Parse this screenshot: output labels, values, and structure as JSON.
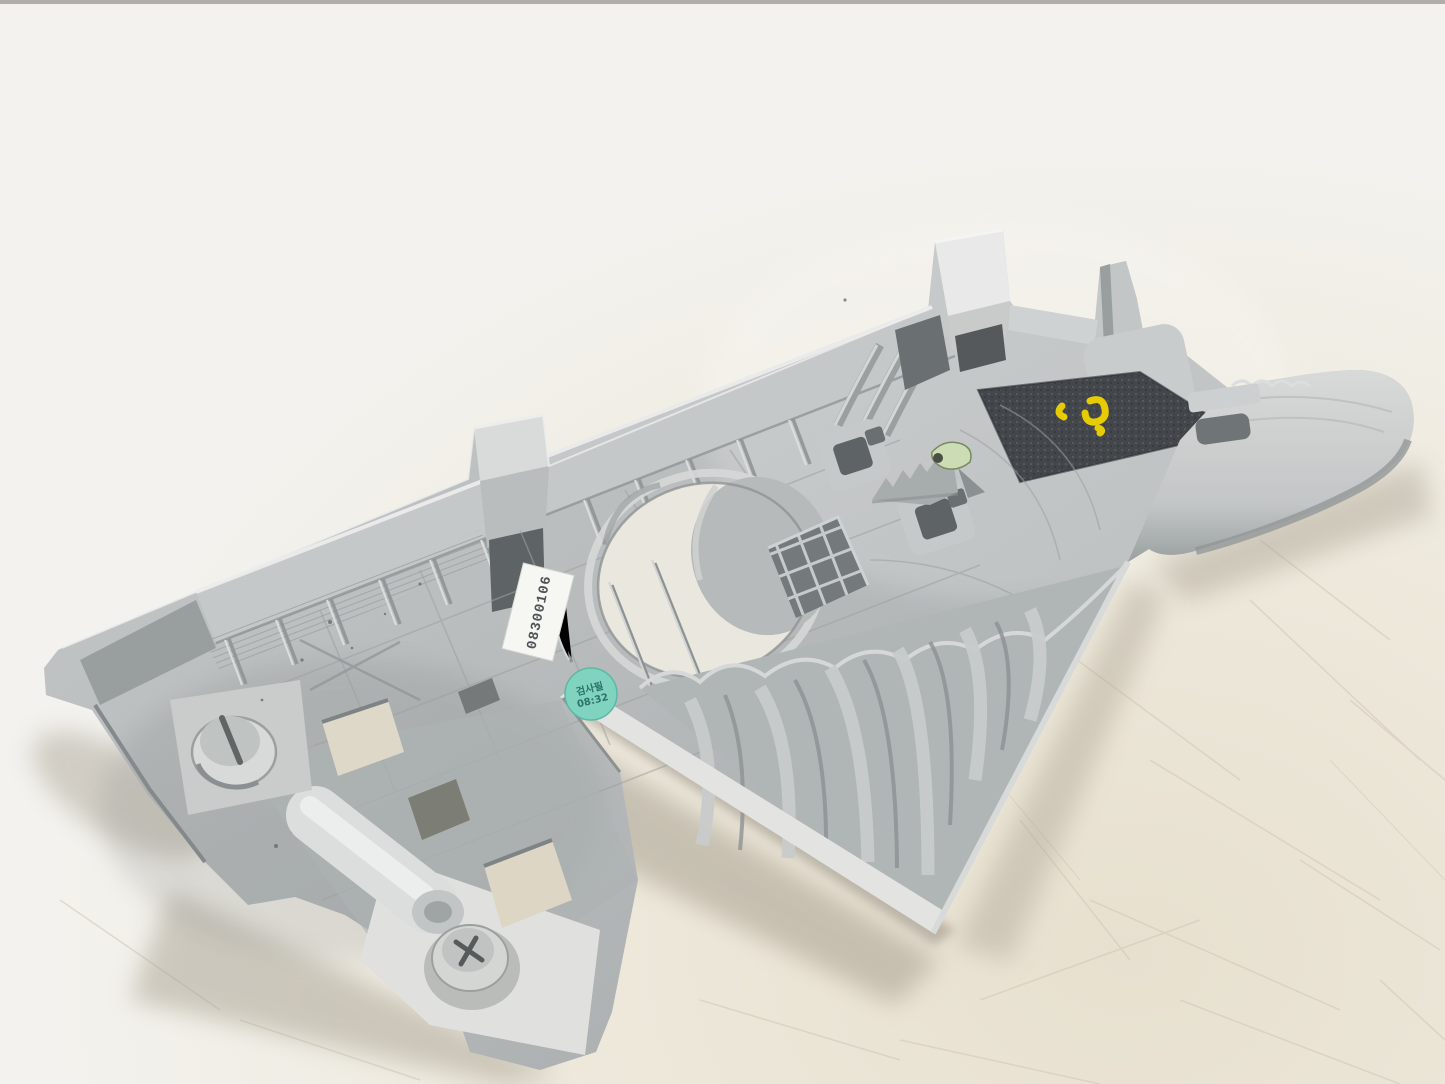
{
  "scene": {
    "description": "Used gray plastic automotive interior trim panel photographed from its back (clip/rib side), lying diagonally on a white scratched work table",
    "surface": "white table top with fine scratches and scuff marks",
    "part_orientation_deg": -21
  },
  "part": {
    "name": "interior trim panel, back side up",
    "color_light": "#dcdedd",
    "color_mid": "#b6baba",
    "color_dark": "#878d8e",
    "felt_pad_color": "#43464a",
    "features": [
      "ribbed top flange with gusset ribs",
      "retainer clip tab",
      "white hook clip bracket",
      "tall alignment post with screw boss and hole",
      "black felt anti-rattle pad",
      "kidney-shaped opening",
      "egg-crate rib lattice",
      "two square clip towers with serrated ridge",
      "broken pale-green clip fragment",
      "scalloped fin ribs along lower edge",
      "curved side wing",
      "lower extension with rectangular cutouts, molded tube and two screw fasteners"
    ]
  },
  "markings": {
    "white_sticker": {
      "text": "08300106",
      "bg": "#f6f6f2",
      "ink": "#4f5357"
    },
    "green_sticker": {
      "line1": "검사필",
      "line2": "08:32",
      "bg": "#7fd3bf",
      "ink": "#1f6358"
    },
    "paint_mark": {
      "color": "#f0d400",
      "description": "yellow QC paint scribble"
    }
  },
  "background": {
    "base": "#f3f2ee",
    "warm_tint": "#e8e2d2",
    "scratch_color": "#cfc8b5",
    "top_edge_strip": "#a6a39d",
    "shadow": "#aaa396"
  }
}
